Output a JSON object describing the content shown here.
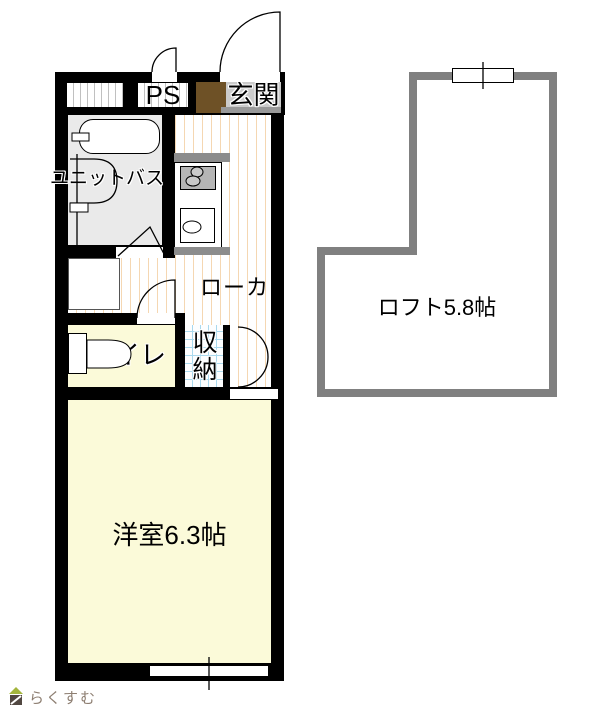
{
  "floor_plan": {
    "labels": {
      "ps": "PS",
      "entrance": "玄関",
      "unit_bath": "ユニットバス",
      "corridor": "ローカ",
      "toilet": "トイレ",
      "storage": "収納",
      "western_room": "洋室6.3帖",
      "loft": "ロフト5.8帖"
    }
  },
  "colors": {
    "wall": "#000000",
    "loft-wall": "#808080",
    "room-floor": "#FBFAD9",
    "bath-floor": "#EAEAEA",
    "corridor-stripe": "#F5D7B2",
    "shaft-stripe": "#C0C0C0",
    "storage-grid": "#A9D9EE",
    "entrance-mat": "#6E5126",
    "entrance-bg": "#CBCBCB",
    "entrance-shadow": "#999999",
    "counter": "#8C8C8C",
    "stove": "#B5B5B5",
    "brand-roof": "#A3B53C",
    "brand-body": "#514741",
    "brand-text": "#8D7E71"
  },
  "footer": {
    "brand": "らくすむ"
  }
}
